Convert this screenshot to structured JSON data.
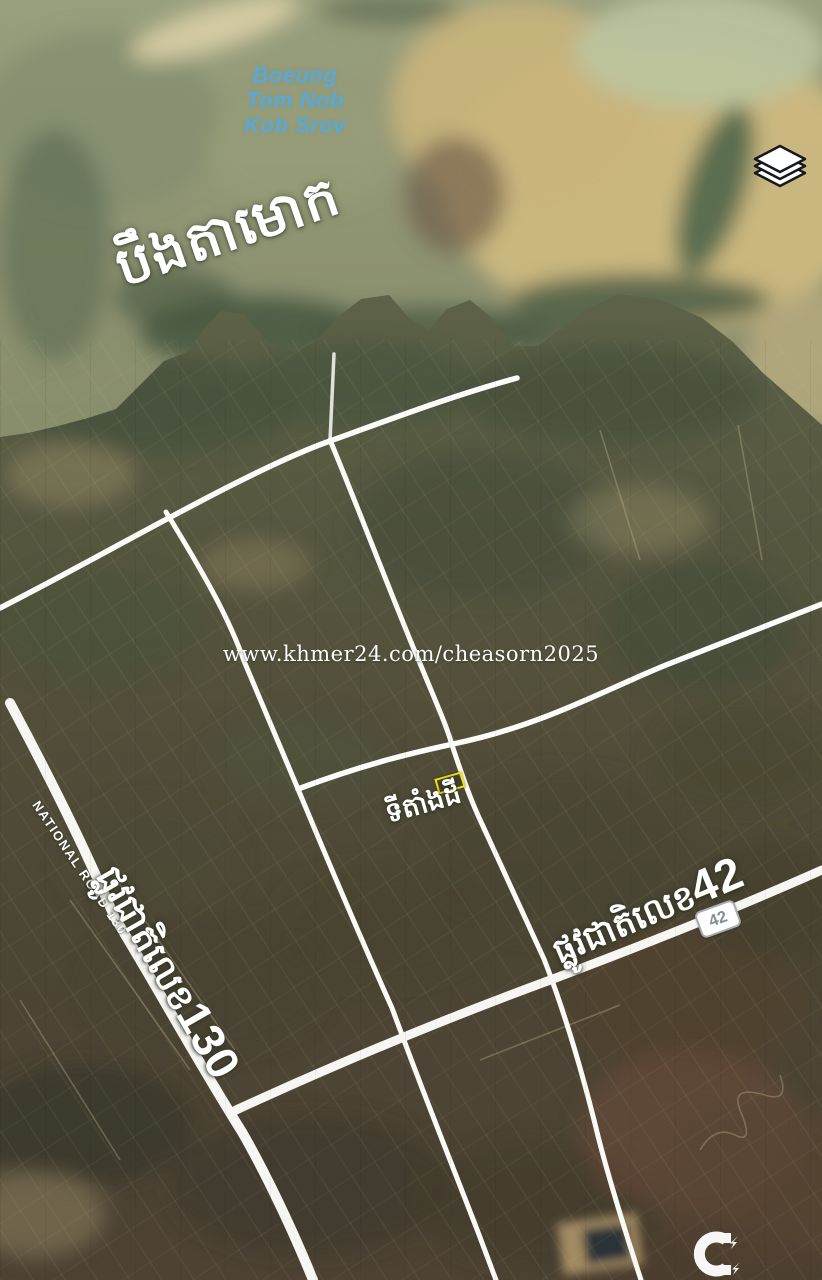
{
  "map": {
    "water_label": {
      "line1": "Boeung",
      "line2": "Tom Nob",
      "line3": "Kob Srov"
    },
    "lake_name_khmer": "បឹងតាមោក",
    "site_label_khmer": "ទីតាំងដី",
    "roads": {
      "national_road_130_en": "NATIONAL ROAD 130",
      "road_130_khmer": "ផ្លូវជាតិលេខ",
      "road_130_number": "130",
      "road_42_khmer": "ផ្លូវជាតិលេខ",
      "road_42_number": "42",
      "route_badge_42": "42"
    }
  },
  "watermark": {
    "text": "www.khmer24.com/cheasorn2025"
  },
  "icons": {
    "layers_icon": "map-layers-stack",
    "logo_icon": "magnet-sparkle-logo"
  },
  "colors": {
    "water_label_blue": "#59a9d8",
    "plot_highlight_yellow": "#f1e40b",
    "road_white": "#f7f6f2",
    "badge_text_gray": "#868d93",
    "water_base": "#8e9372",
    "flats_tan": "#cdb87f"
  }
}
